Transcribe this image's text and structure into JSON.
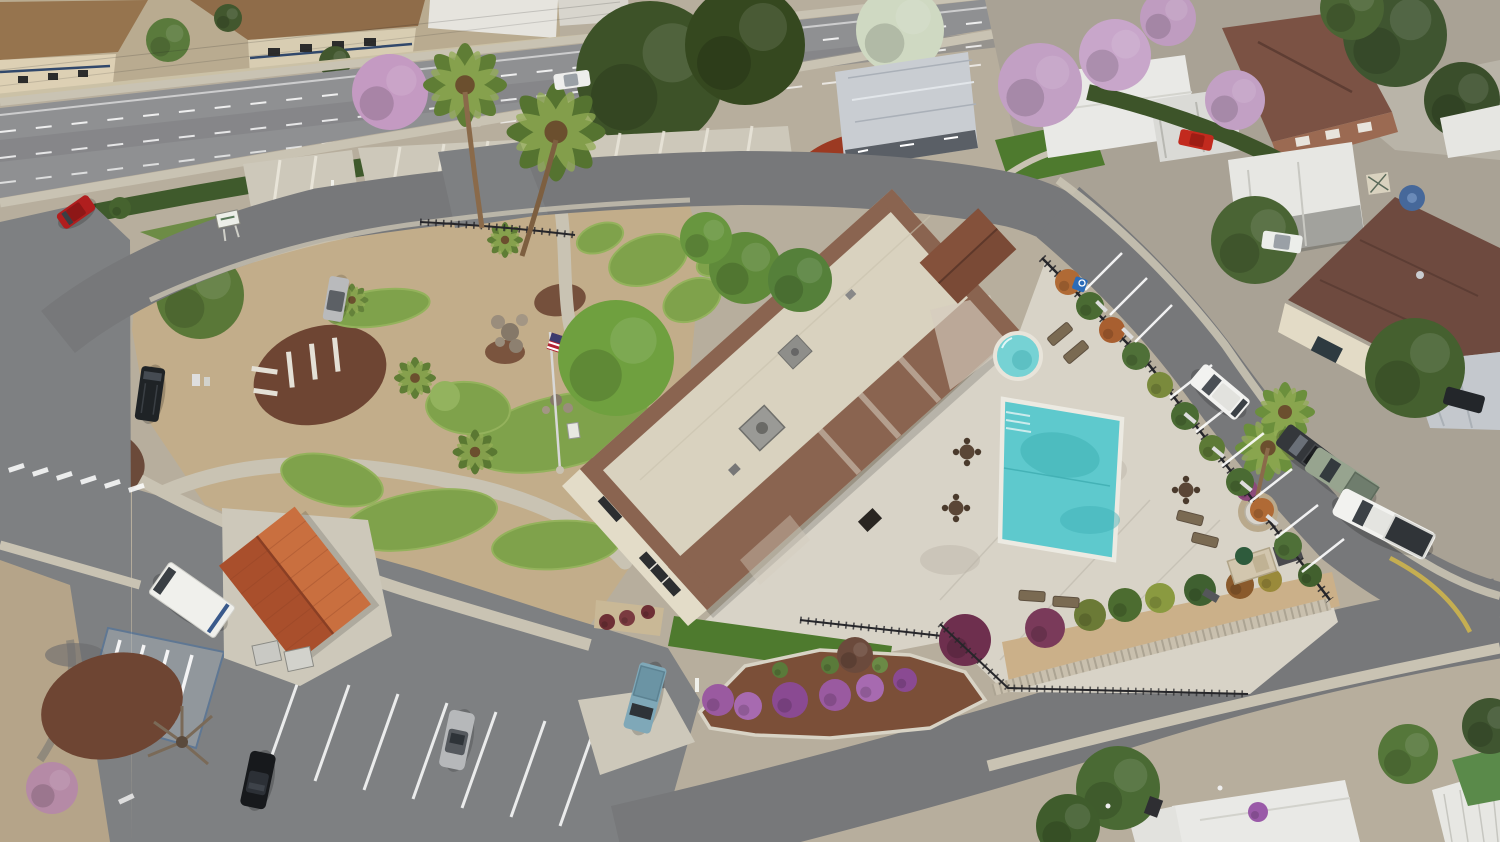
{
  "scene": {
    "caption": "Aerial drone photograph of a mobile home community clubhouse complex with swimming pool, round spa, mini putting-golf course, flagpole with US flag, parking lots and surrounding mobile homes along a public road",
    "type": "aerial-photo",
    "time_of_day": "daytime, overcast-bright",
    "visible_text": "none"
  },
  "palette": {
    "asphalt": "#8f9092",
    "asphalt2": "#77787a",
    "lot": "#7e8082",
    "concrete": "#d8d3c7",
    "concrete2": "#cdc8ba",
    "sidewalk": "#c9c3b3",
    "dirt": "#c2ad8a",
    "mulch": "#6e4533",
    "mulch2": "#7b4f38",
    "turf": "#7fa24b",
    "lawn": "#4e7a2e",
    "pool_water": "#5ec9cd",
    "spa_water": "#76d2d4",
    "roof_cream": "#d9d2bf",
    "roof_tile": "#8a6450",
    "terracotta": "#bf5f35",
    "white_home": "#e9e9e6",
    "metal_roof": "#c9cdd2",
    "red_gravel": "#9c3a22",
    "fence": "#26262a",
    "handicap_blue": "#2b6cb8",
    "yellow_curb": "#cdb44c",
    "flag_red": "#b22234",
    "flag_blue": "#3c3b6e"
  },
  "objects": {
    "buildings": [
      "clubhouse with cream flat roof and brown tile hips",
      "terracotta-roof mail kiosk",
      "small dark-brown roof outbuilding",
      "tudor apartment buildings along road",
      "brick two-story house",
      "white mobile homes with carports",
      "brown-roof mobile home",
      "bottom white mobile home roofs"
    ],
    "amenities": [
      "rectangular swimming pool with steps",
      "round spa",
      "pool deck with lounge chairs",
      "three round patio tables",
      "pedestal fountain",
      "bbq counter with green umbrella",
      "mini putting golf greens",
      "flagpole with US flag",
      "black iron pool fence",
      "decorative retaining wall with shrubs"
    ],
    "vehicles": [
      "red car at entrance",
      "white car on main road",
      "silver car at golf parking",
      "black SUV in west drive",
      "white mail truck",
      "black sedan",
      "silver sedan",
      "light-blue pickup",
      "white SUV at pool parking",
      "dark gray pickup",
      "sage green pickup",
      "white pickup at curve",
      "red car under carport",
      "white car under carport",
      "dark car under far carport"
    ],
    "markings": [
      "handicap stall with blue hatching",
      "white parking stall stripes",
      "dashed lane lines on public road",
      "yellow painted curb",
      "crosswalk bars"
    ],
    "vegetation": [
      "palm trees",
      "dark conifers",
      "pink blossom trees",
      "white blossom tree",
      "hedges",
      "purple flowering shrubs",
      "mulch islands",
      "lawn strips"
    ]
  }
}
